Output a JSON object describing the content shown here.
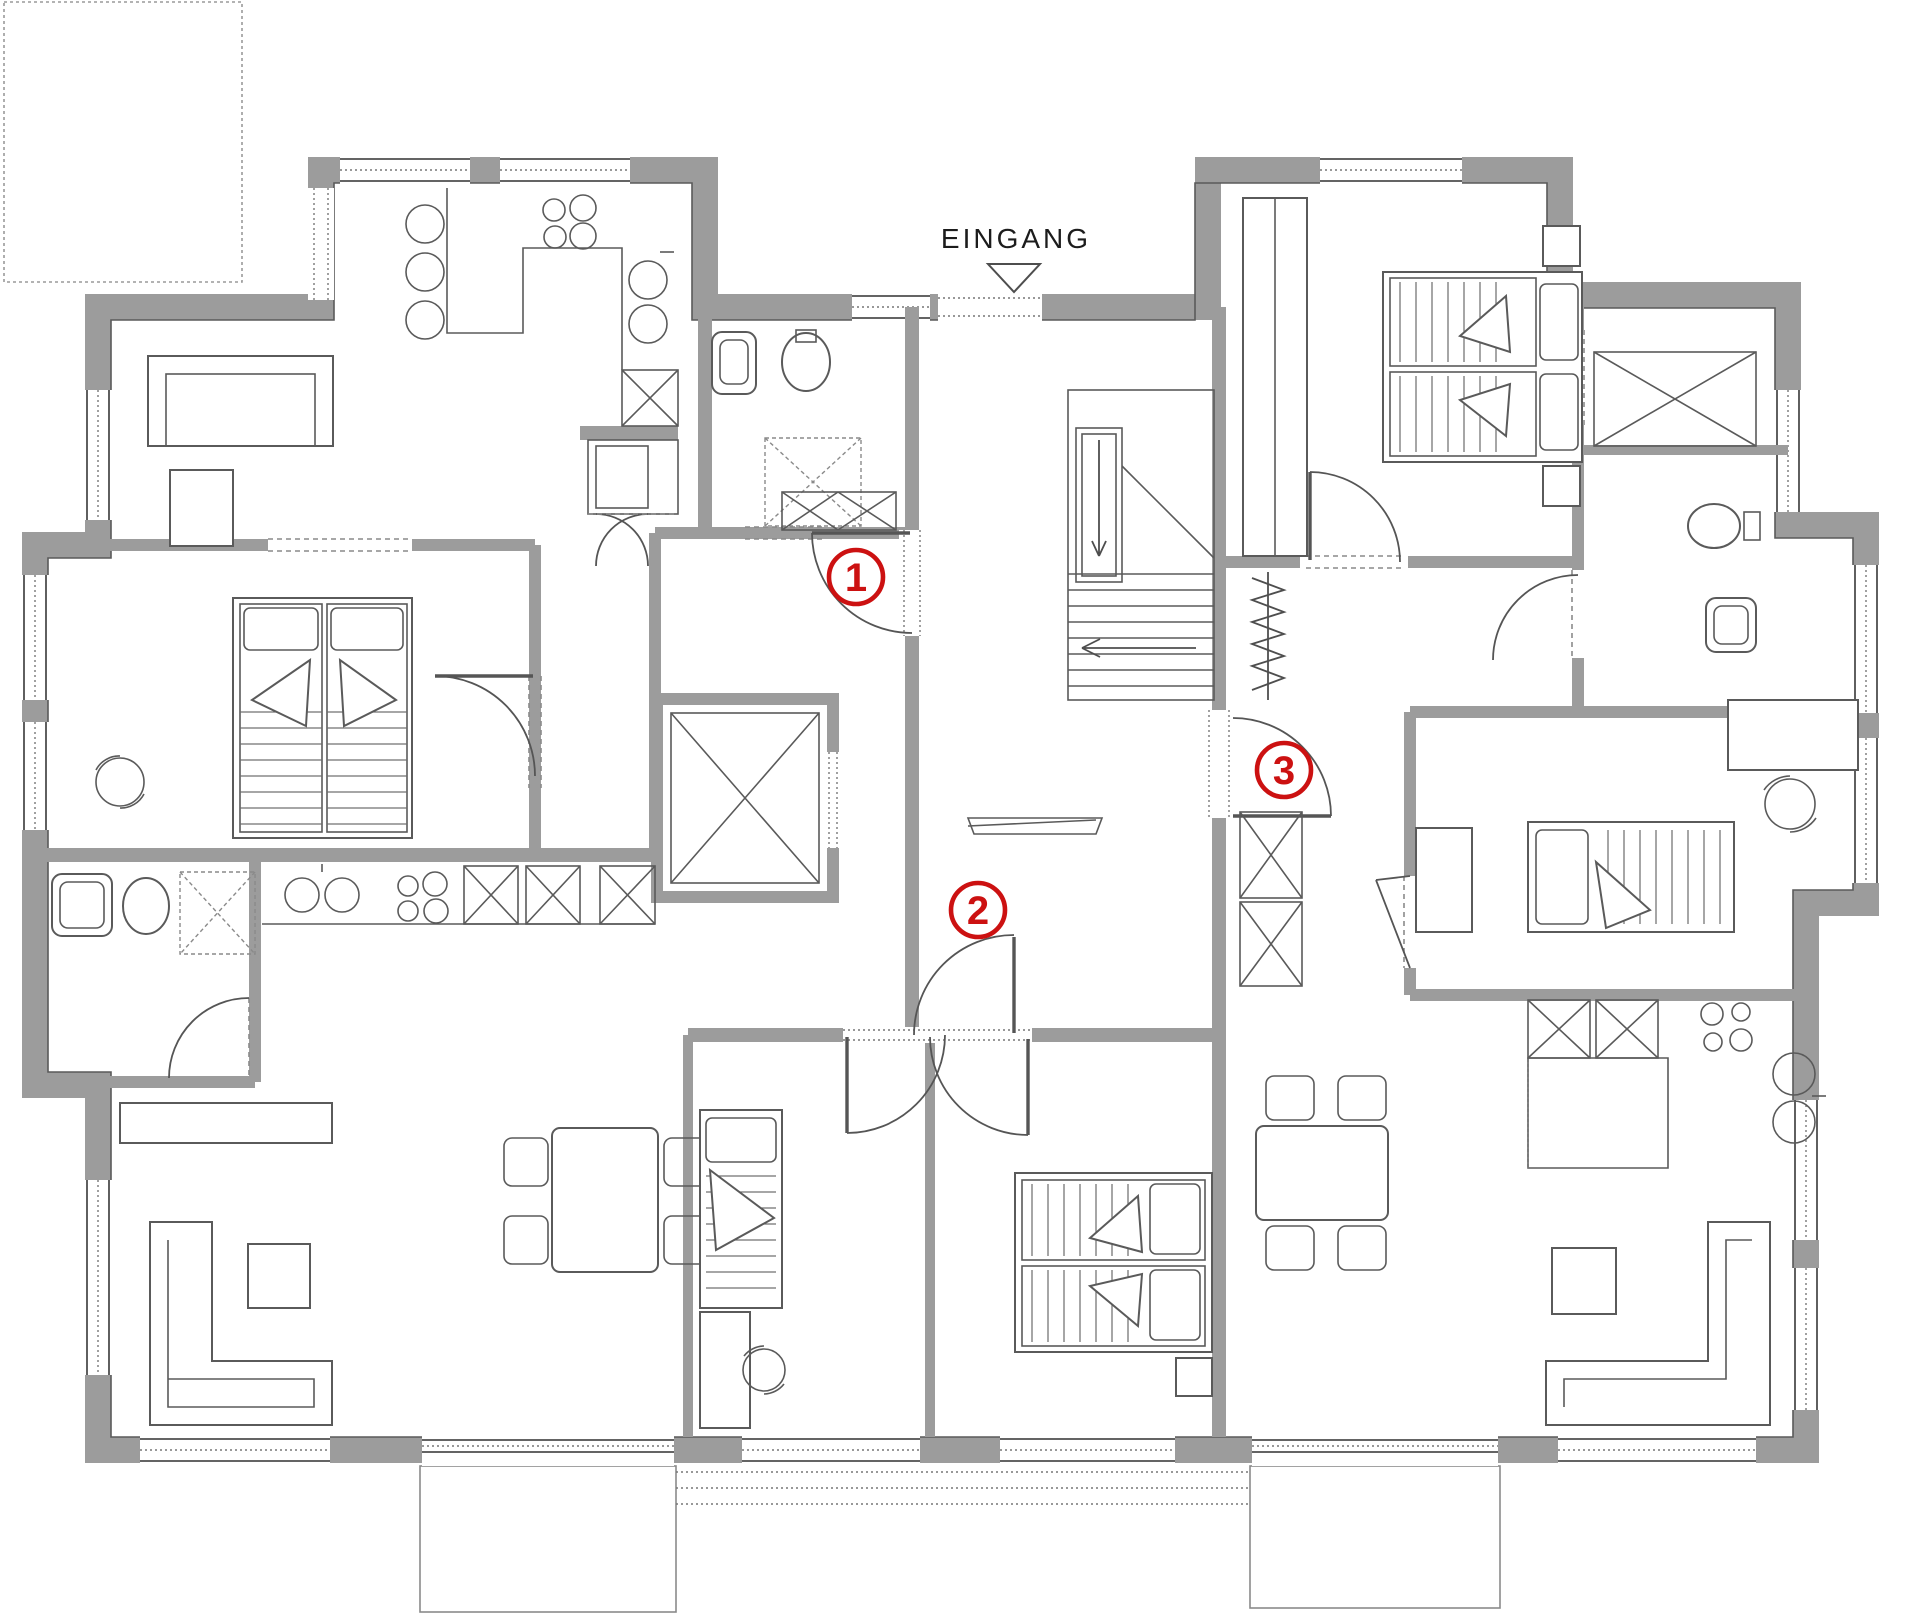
{
  "plan": {
    "type": "floorplan",
    "entrance": {
      "label": "EINGANG",
      "marker": "triangle-down"
    },
    "apartments": [
      {
        "number": "1",
        "name": "apartment-1-top-left"
      },
      {
        "number": "2",
        "name": "apartment-2-bottom-left"
      },
      {
        "number": "3",
        "name": "apartment-3-right"
      }
    ],
    "colors": {
      "wall": "#9c9c9c",
      "line": "#4e4e4e",
      "furniture": "#5a5a5a",
      "accent_red": "#cc1111",
      "background": "#ffffff"
    },
    "features": [
      "stairs",
      "elevator",
      "kitchens",
      "bathrooms",
      "bedrooms",
      "terraces",
      "balcony-dashed-top-left"
    ]
  }
}
